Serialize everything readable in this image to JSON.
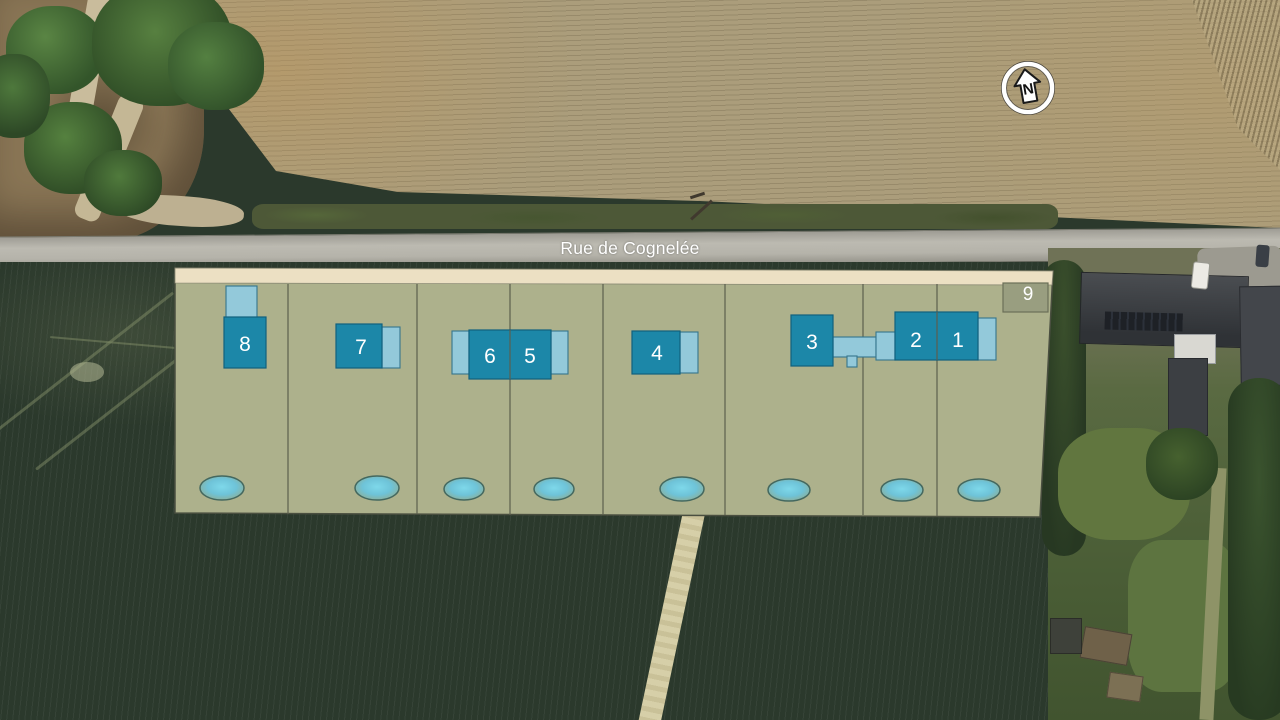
{
  "plan": {
    "street_label": "Rue de Cognelée",
    "north_label": "N"
  },
  "lots": [
    {
      "number": "1"
    },
    {
      "number": "2"
    },
    {
      "number": "3"
    },
    {
      "number": "4"
    },
    {
      "number": "5"
    },
    {
      "number": "6"
    },
    {
      "number": "7"
    },
    {
      "number": "8"
    },
    {
      "number": "9"
    }
  ],
  "colors": {
    "parcel_fill": "#adb18c",
    "frontage_fill": "#ece0c3",
    "house_fill": "#1c87a8",
    "house_stroke": "#11607e",
    "garage_fill": "#93c9da",
    "garage_stroke": "#35758c",
    "lot9_fill": "#999e80",
    "lot9_stroke": "#6b6f58",
    "pond_core": "#7ed8ea",
    "pond_edge": "#8fae94",
    "pond_stroke": "#44685f",
    "outline": "#4a4f40",
    "divider": "#5c5f4e",
    "label_text": "#ffffff",
    "field_top": "#ab9d7b",
    "field_dark": "#2b392c",
    "road_fill": "#b3b1a9"
  }
}
